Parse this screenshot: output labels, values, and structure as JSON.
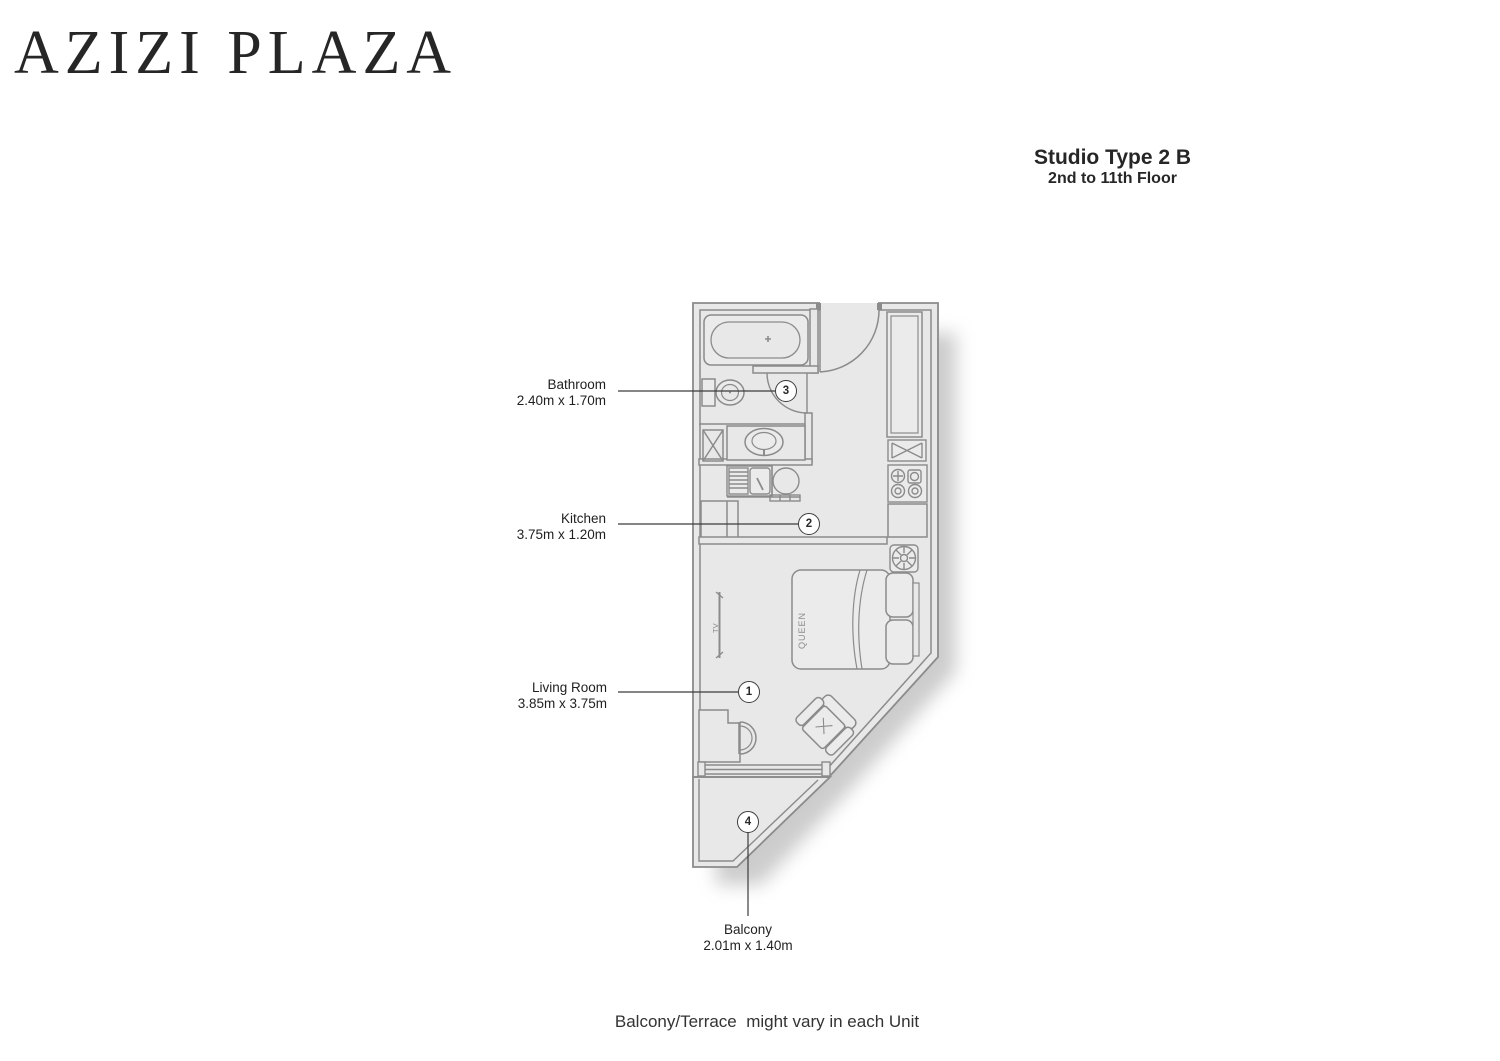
{
  "brand": {
    "name": "AZIZI PLAZA"
  },
  "unit": {
    "type": "Studio Type 2 B",
    "floors": "2nd to 11th Floor"
  },
  "rooms": [
    {
      "num": "3",
      "name": "Bathroom",
      "dims": "2.40m x 1.70m"
    },
    {
      "num": "2",
      "name": "Kitchen",
      "dims": "3.75m x 1.20m"
    },
    {
      "num": "1",
      "name": "Living Room",
      "dims": "3.85m x 3.75m"
    },
    {
      "num": "4",
      "name": "Balcony",
      "dims": "2.01m x 1.40m"
    }
  ],
  "plan": {
    "bed_label": "QUEEN",
    "tv_label": "TV"
  },
  "footnote": "Balcony/Terrace  might vary in each Unit",
  "colors": {
    "line": "#8b8b8b",
    "floor": "#e8e8e8",
    "ink": "#3c3c3c"
  }
}
